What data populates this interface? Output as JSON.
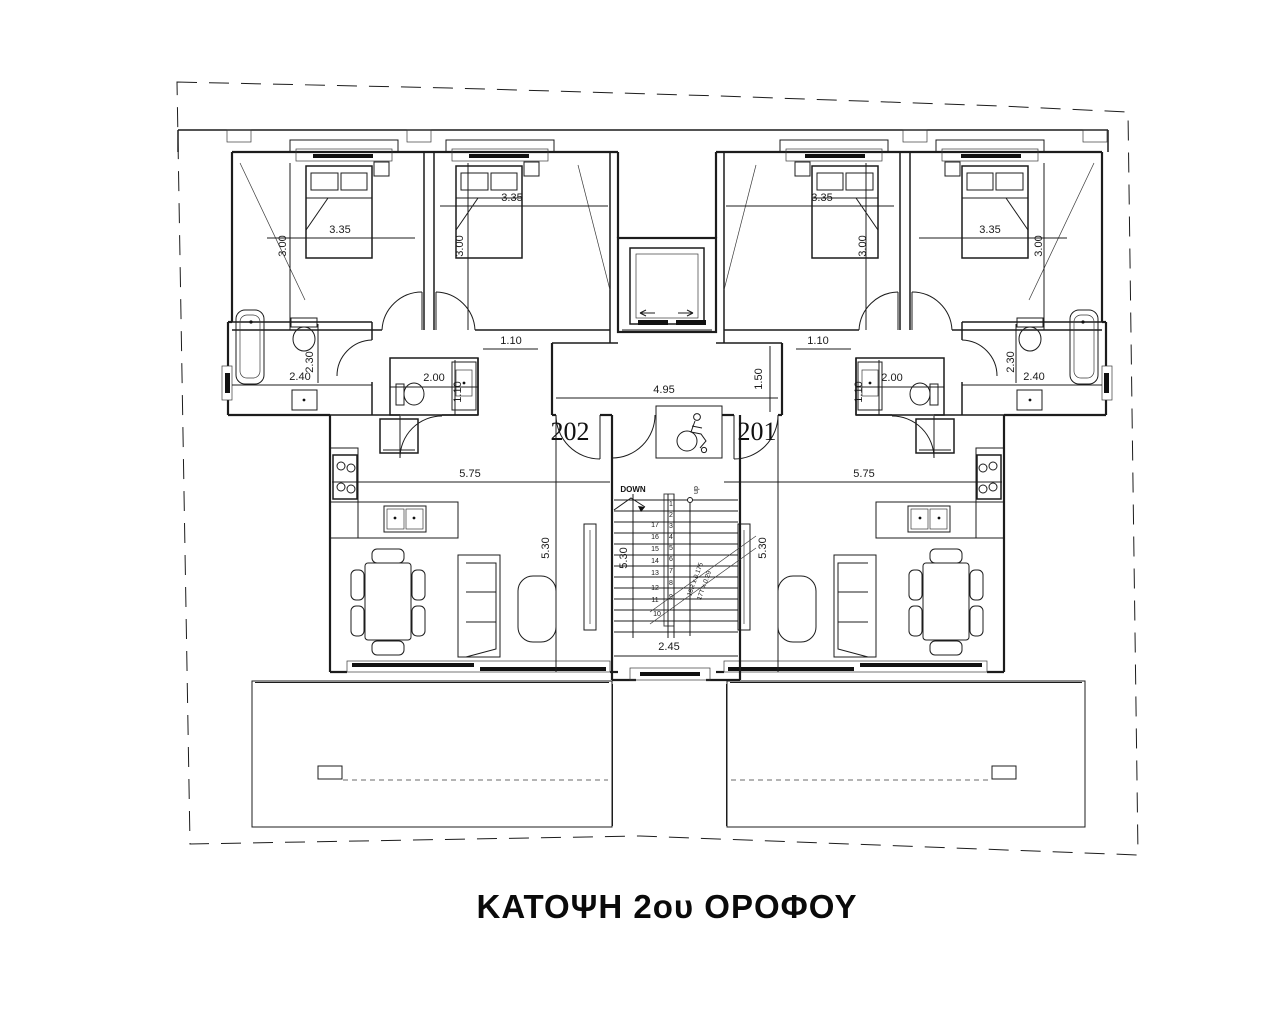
{
  "title": "ΚΑΤΟΨΗ 2ου ΟΡΟΦΟΥ",
  "apartments": {
    "left": {
      "number": "202"
    },
    "right": {
      "number": "201"
    }
  },
  "dimensions": {
    "bedroom_width": "3.35",
    "bedroom_depth": "3.00",
    "bathroom_width": "2.40",
    "bathroom_depth": "2.30",
    "wc_width": "2.00",
    "corridor_width": "1.10",
    "hall_width": "4.95",
    "hall_depth": "1.50",
    "living_width": "5.75",
    "living_depth": "5.30",
    "stair_width": "2.45",
    "stair_length": "5.30"
  },
  "stairs": {
    "down_label": "DOWN",
    "up_label": "dn",
    "riser_note": "18R x 0.175",
    "tread_note": "17T x 0.29",
    "left_steps": [
      "17",
      "16",
      "15",
      "14",
      "13",
      "12",
      "11",
      "10"
    ],
    "right_steps": [
      "1",
      "2",
      "3",
      "4",
      "5",
      "6",
      "7",
      "8",
      "9"
    ]
  },
  "colors": {
    "boundary": "#9b4a44",
    "balcony_border": "#8a97d8",
    "glass": "#8fd0d0",
    "elevator_arrows": "#c06a28",
    "stair_guide": "#9a9ac8"
  }
}
